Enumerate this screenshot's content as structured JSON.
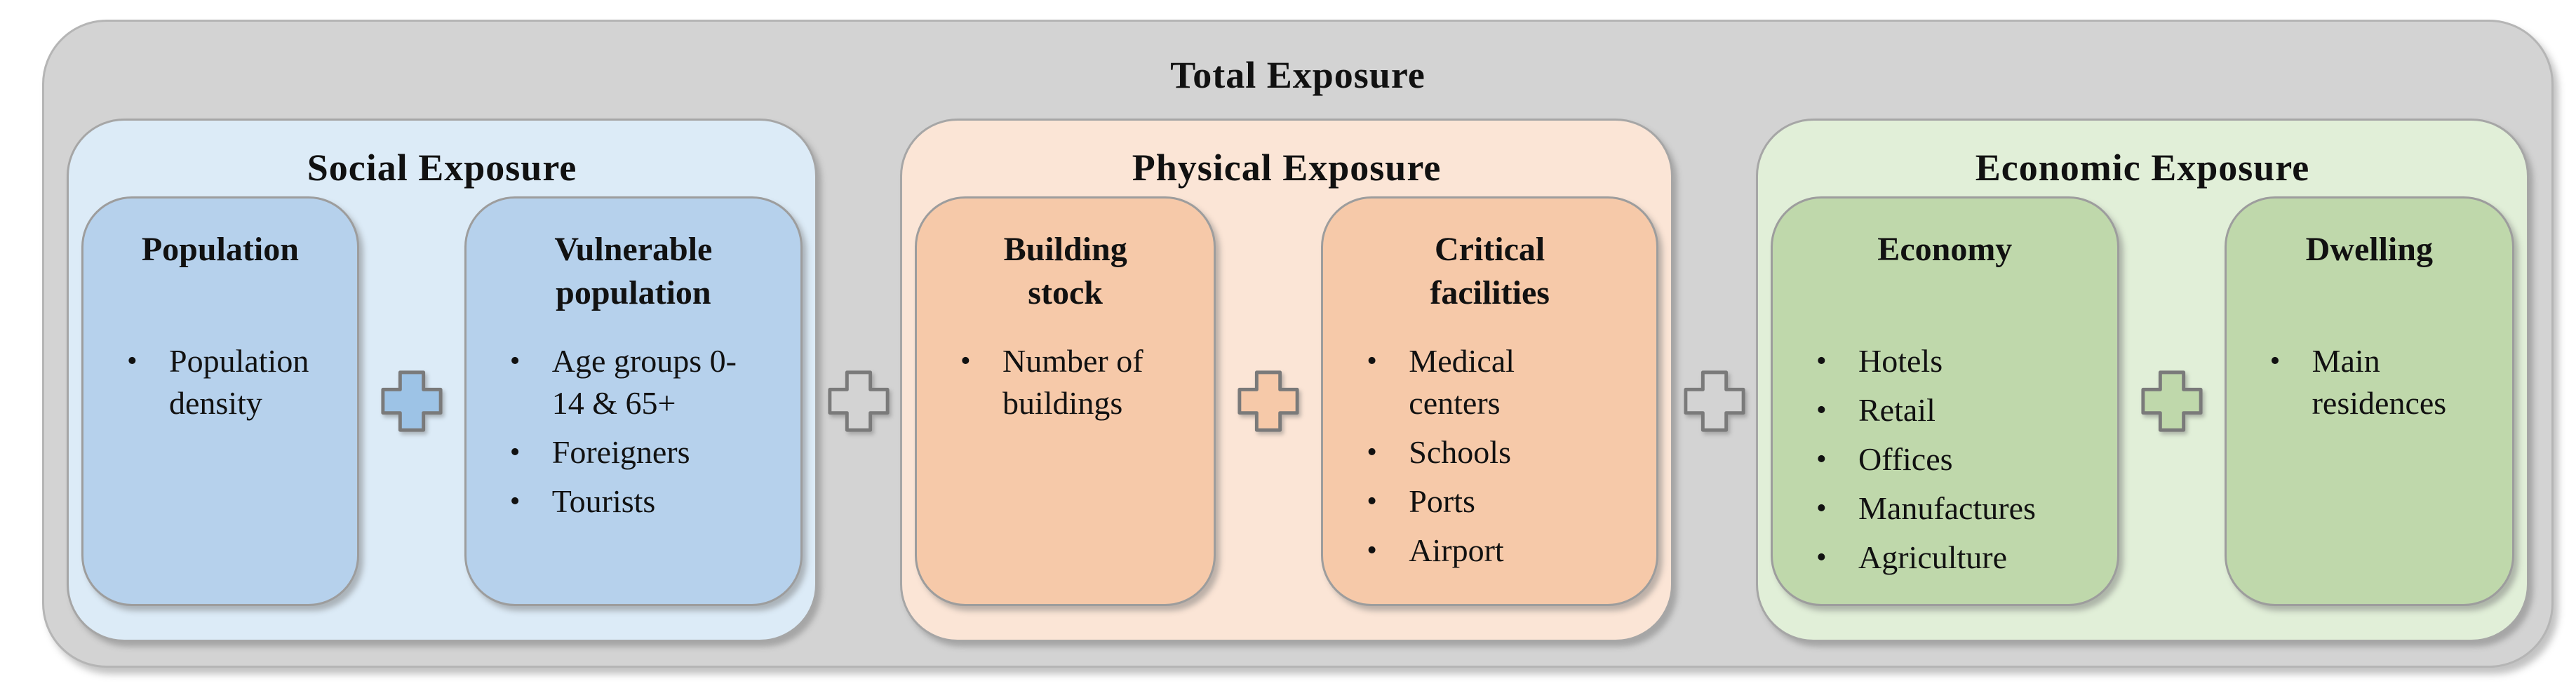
{
  "diagram": {
    "title": "Total Exposure",
    "bullet_glyph": "•",
    "colors": {
      "outer_bg": "#d3d3d3",
      "plus_gray_fill": "#d3d3d3",
      "plus_border": "#7a7a7a",
      "text": "#111111"
    },
    "sections": [
      {
        "title": "Social Exposure",
        "colors": {
          "section_bg": "#dcebf7",
          "box_bg": "#b6d1ec",
          "plus_fill": "#9dc3e6"
        },
        "boxes": [
          {
            "title": "Population",
            "items": [
              "Population density"
            ]
          },
          {
            "title": "Vulnerable population",
            "items": [
              "Age groups 0-14 & 65+",
              "Foreigners",
              "Tourists"
            ]
          }
        ]
      },
      {
        "title": "Physical Exposure",
        "colors": {
          "section_bg": "#fbe5d6",
          "box_bg": "#f6c9a9",
          "plus_fill": "#f6c9a9"
        },
        "boxes": [
          {
            "title": "Building stock",
            "items": [
              "Number of buildings"
            ]
          },
          {
            "title": "Critical facilities",
            "items": [
              "Medical centers",
              "Schools",
              "Ports",
              "Airport"
            ]
          }
        ]
      },
      {
        "title": "Economic Exposure",
        "colors": {
          "section_bg": "#e1efd8",
          "box_bg": "#bfd8ab",
          "plus_fill": "#bfd8ab"
        },
        "boxes": [
          {
            "title": "Economy",
            "items": [
              "Hotels",
              "Retail",
              "Offices",
              "Manufactures",
              "Agriculture"
            ]
          },
          {
            "title": "Dwelling",
            "items": [
              "Main residences"
            ]
          }
        ]
      }
    ]
  }
}
